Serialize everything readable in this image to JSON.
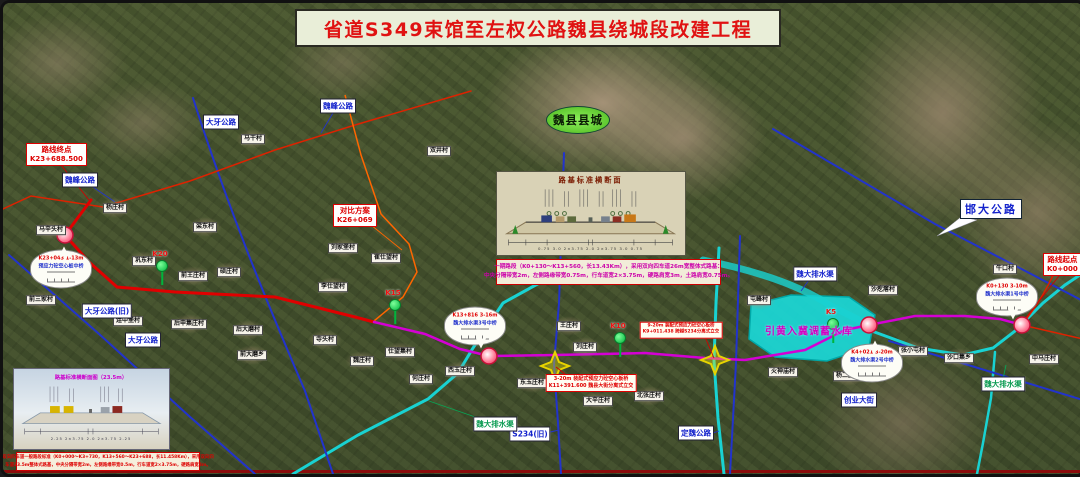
{
  "title": "省道S349束馆至左权公路魏县绕城段改建工程",
  "town": "魏县县城",
  "reservoir": "引黄入冀调蓄水库",
  "route_markers": {
    "end": {
      "l1": "路线终点",
      "l2": "K23+688.500",
      "x": 23,
      "y": 140
    },
    "start": {
      "l1": "路线起点",
      "l2": "K0+000",
      "x": 1040,
      "y": 250
    },
    "alt": {
      "l1": "对比方案",
      "l2": "K26+069",
      "x": 330,
      "y": 201
    }
  },
  "km_markers": [
    {
      "label": "K20",
      "x": 159,
      "y": 263
    },
    {
      "label": "K15",
      "x": 392,
      "y": 302
    },
    {
      "label": "K10",
      "x": 617,
      "y": 335
    },
    {
      "label": "K5",
      "x": 830,
      "y": 321
    }
  ],
  "balloons": [
    {
      "l1": "K23+043 1-13m",
      "l2": "预应力砼空心板中桥",
      "x": 58,
      "y": 266,
      "dir": "up"
    },
    {
      "l1": "K13+816 3-16m",
      "l2": "魏大排水渠3号中桥",
      "x": 472,
      "y": 323,
      "dir": "down"
    },
    {
      "l1": "K4+021 3-20m",
      "l2": "魏大排水渠2号中桥",
      "x": 869,
      "y": 360,
      "dir": "up"
    },
    {
      "l1": "K0+130 3-10m",
      "l2": "魏大排水渠1号中桥",
      "x": 1004,
      "y": 294,
      "dir": "down"
    }
  ],
  "interchanges": [
    {
      "l1": "3-20m 装配式预应力砼空心板桥",
      "l2": "K11+391.600 魏县大街分离式立交",
      "x": 588,
      "y": 380,
      "fs": 5
    },
    {
      "l1": "9-20m 装配式预应力砼空心板桥",
      "l2": "K9+011.438 跨越S234分离式立交",
      "x": 678,
      "y": 327,
      "fs": 4.5
    }
  ],
  "road_labels": [
    {
      "t": "魏峰公路",
      "x": 77,
      "y": 177,
      "c": "blue"
    },
    {
      "t": "魏峰公路",
      "x": 335,
      "y": 103,
      "c": "blue"
    },
    {
      "t": "大牙公路",
      "x": 218,
      "y": 119,
      "c": "blue"
    },
    {
      "t": "大牙公路(旧)",
      "x": 104,
      "y": 308,
      "c": "blue"
    },
    {
      "t": "大牙公路",
      "x": 140,
      "y": 337,
      "c": "blue"
    },
    {
      "t": "邯大公路",
      "x": 988,
      "y": 206,
      "c": "blue",
      "big": true
    },
    {
      "t": "定魏公路",
      "x": 693,
      "y": 430,
      "c": "blue"
    },
    {
      "t": "S234(旧)",
      "x": 527,
      "y": 431,
      "c": "blue"
    },
    {
      "t": "创业大街",
      "x": 856,
      "y": 397,
      "c": "blue"
    },
    {
      "t": "魏大排水渠",
      "x": 812,
      "y": 271,
      "c": "blue"
    },
    {
      "t": "魏大排水渠",
      "x": 492,
      "y": 421,
      "c": "green"
    },
    {
      "t": "魏大排水渠",
      "x": 1000,
      "y": 381,
      "c": "green"
    }
  ],
  "villages": [
    {
      "t": "马干村",
      "x": 250,
      "y": 136
    },
    {
      "t": "双井村",
      "x": 436,
      "y": 148
    },
    {
      "t": "杨庄村",
      "x": 112,
      "y": 205
    },
    {
      "t": "马辛头村",
      "x": 48,
      "y": 227
    },
    {
      "t": "巩东村",
      "x": 141,
      "y": 258
    },
    {
      "t": "梁东村",
      "x": 202,
      "y": 224
    },
    {
      "t": "前王庄村",
      "x": 190,
      "y": 273
    },
    {
      "t": "硕庄村",
      "x": 226,
      "y": 269
    },
    {
      "t": "前三家村",
      "x": 38,
      "y": 297
    },
    {
      "t": "连中堡村",
      "x": 125,
      "y": 318
    },
    {
      "t": "后申集庄村",
      "x": 186,
      "y": 321
    },
    {
      "t": "刘家堡村",
      "x": 340,
      "y": 245
    },
    {
      "t": "崔仕望村",
      "x": 383,
      "y": 255
    },
    {
      "t": "李仕望村",
      "x": 330,
      "y": 284
    },
    {
      "t": "后大磨村",
      "x": 245,
      "y": 327
    },
    {
      "t": "前大磨乡",
      "x": 249,
      "y": 352
    },
    {
      "t": "寺头村",
      "x": 322,
      "y": 337
    },
    {
      "t": "魏庄村",
      "x": 359,
      "y": 358
    },
    {
      "t": "仕望集村",
      "x": 397,
      "y": 349
    },
    {
      "t": "西玉庄村",
      "x": 457,
      "y": 368
    },
    {
      "t": "何庄村",
      "x": 418,
      "y": 376
    },
    {
      "t": "东玉庄村",
      "x": 529,
      "y": 380
    },
    {
      "t": "王庄村",
      "x": 566,
      "y": 323
    },
    {
      "t": "刘庄村",
      "x": 582,
      "y": 344
    },
    {
      "t": "大辛庄村",
      "x": 595,
      "y": 398
    },
    {
      "t": "北张庄村",
      "x": 646,
      "y": 393
    },
    {
      "t": "屯峰村",
      "x": 756,
      "y": 297
    },
    {
      "t": "火神庙村",
      "x": 780,
      "y": 369
    },
    {
      "t": "杨二庄村",
      "x": 845,
      "y": 373
    },
    {
      "t": "沙疙瘩村",
      "x": 880,
      "y": 287
    },
    {
      "t": "张小屯村",
      "x": 910,
      "y": 348
    },
    {
      "t": "沙口集乡",
      "x": 956,
      "y": 355
    },
    {
      "t": "牛口村",
      "x": 1002,
      "y": 266
    },
    {
      "t": "中马庄村",
      "x": 1041,
      "y": 356
    }
  ],
  "spec_center": {
    "l1": "一期路段（K0+130～K13+560，长13.43Km），采用双向四车道26m宽整体式路基：",
    "l2": "中央分隔带宽2m，左侧路缘带宽0.75m，行车道宽2×3.75m，硬路肩宽3m，土路肩宽0.75m。"
  },
  "spec_bottom": {
    "l1": "双向四车道一般路段标准（K0+000～K3+730，K13+560～K23+688，长11.458Km），采用双向四",
    "l2": "车道23.5m整体式路基，中央分隔带宽2m，左侧路缘带宽0.5m，行车道宽2×3.75m，硬路肩宽3m。"
  },
  "cross_top": {
    "title": "路基标准横断面",
    "dims": "0.75  3.0  2×3.75  2.0  2×3.75  3.0  0.75"
  },
  "cross_bottom": {
    "title": "路基标准横断面图（23.5m）",
    "dims": "2.25  2×3.75  2.0  2×3.75  2.25"
  }
}
